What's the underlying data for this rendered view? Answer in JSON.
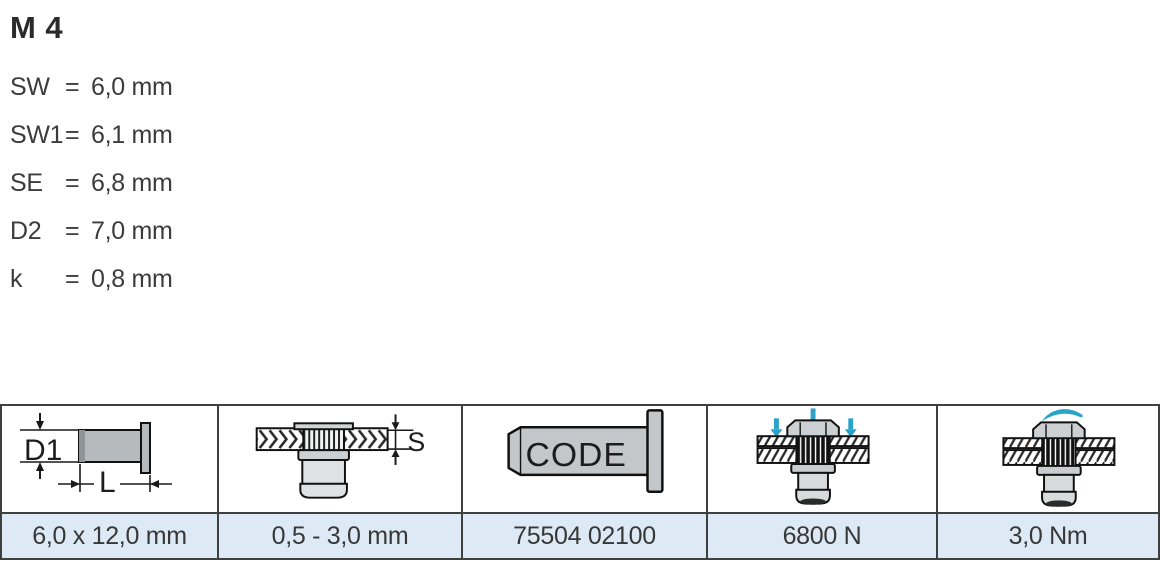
{
  "header": {
    "title": "M 4",
    "specs": [
      {
        "label": "SW",
        "eq": "=",
        "value": "6,0 mm"
      },
      {
        "label": "SW1",
        "eq": "=",
        "value": "6,1 mm"
      },
      {
        "label": "SE",
        "eq": "=",
        "value": "6,8 mm"
      },
      {
        "label": "D2",
        "eq": "=",
        "value": "7,0 mm"
      },
      {
        "label": "k",
        "eq": "=",
        "value": "0,8 mm"
      }
    ]
  },
  "table": {
    "columns": [
      {
        "icon": "diameter-length-diagram",
        "icon_labels": [
          "D1",
          "L"
        ],
        "value": "6,0 x 12,0 mm"
      },
      {
        "icon": "grip-range-diagram",
        "icon_labels": [
          "S"
        ],
        "value": "0,5 - 3,0 mm"
      },
      {
        "icon": "part-code-diagram",
        "icon_labels": [
          "CODE"
        ],
        "value": "75504 02100"
      },
      {
        "icon": "axial-force-diagram",
        "icon_labels": [],
        "value": "6800 N"
      },
      {
        "icon": "torque-diagram",
        "icon_labels": [],
        "value": "3,0 Nm"
      }
    ]
  },
  "colors": {
    "accent_blue": "#2ba3c9",
    "value_row_bg": "#dde9f5",
    "table_border": "#3f3f3f",
    "text": "#3b3b3b",
    "metal_gray": "#bcc0c2"
  }
}
